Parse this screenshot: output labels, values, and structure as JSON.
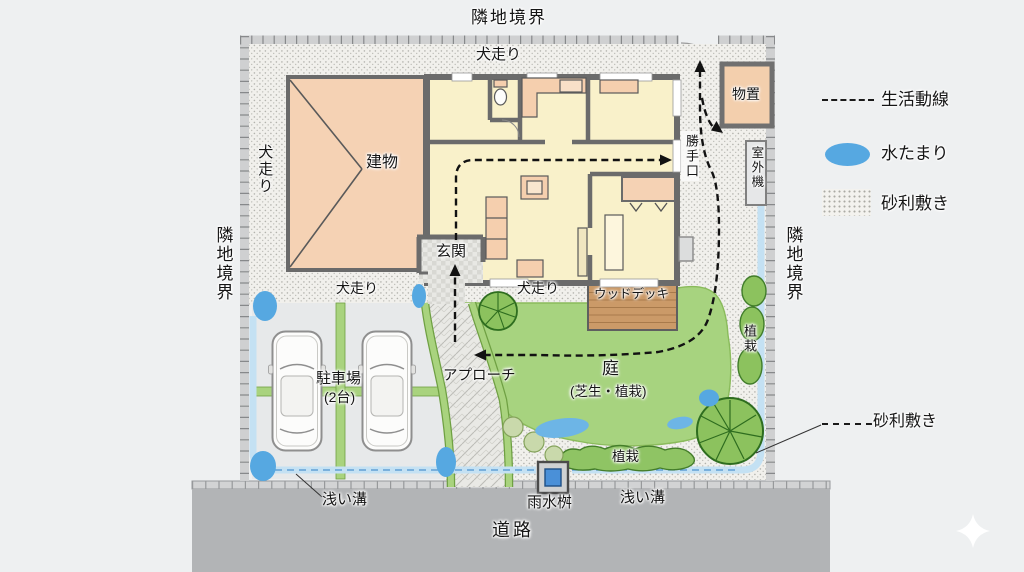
{
  "diagram": {
    "boundaries": {
      "top": "隣地境界",
      "left": "隣地境界",
      "right": "隣地境界"
    },
    "road": {
      "label": "道路"
    },
    "site": {
      "dog_run_labels": [
        "犬走り",
        "犬走り",
        "犬走り",
        "犬走り"
      ],
      "building_label": "建物",
      "shed_label": "物置",
      "back_door_label": "勝手口",
      "outdoor_unit_label": "室外機",
      "entrance_label": "玄関",
      "wood_deck_label": "ウッドデッキ",
      "approach_label": "アプローチ",
      "garden": {
        "title": "庭",
        "subtitle": "(芝生・植栽)",
        "planting_bottom": "植栽",
        "planting_right": "植栽"
      },
      "parking": {
        "line1": "駐車場",
        "line2": "(2台)"
      },
      "ditch_labels": {
        "left": "浅い溝",
        "right": "浅い溝"
      },
      "rain_basin_label": "雨水桝"
    },
    "legend": {
      "items": [
        {
          "label": "生活動線",
          "swatch": "dashed-line"
        },
        {
          "label": "水たまり",
          "swatch": "blue-ellipse",
          "color": "#56a8e1"
        },
        {
          "label": "砂利敷き",
          "swatch": "gravel-dots"
        }
      ]
    },
    "annotation": {
      "gravel": "砂利敷き"
    },
    "colors": {
      "puddle": "#56a8e1",
      "lawn": "#a7d37f",
      "deck": "#cb9a68",
      "roof": "#f5d2b4",
      "floor": "#f9f1ca",
      "road": "#b2b4b6",
      "shed": "#f3cfad"
    }
  }
}
